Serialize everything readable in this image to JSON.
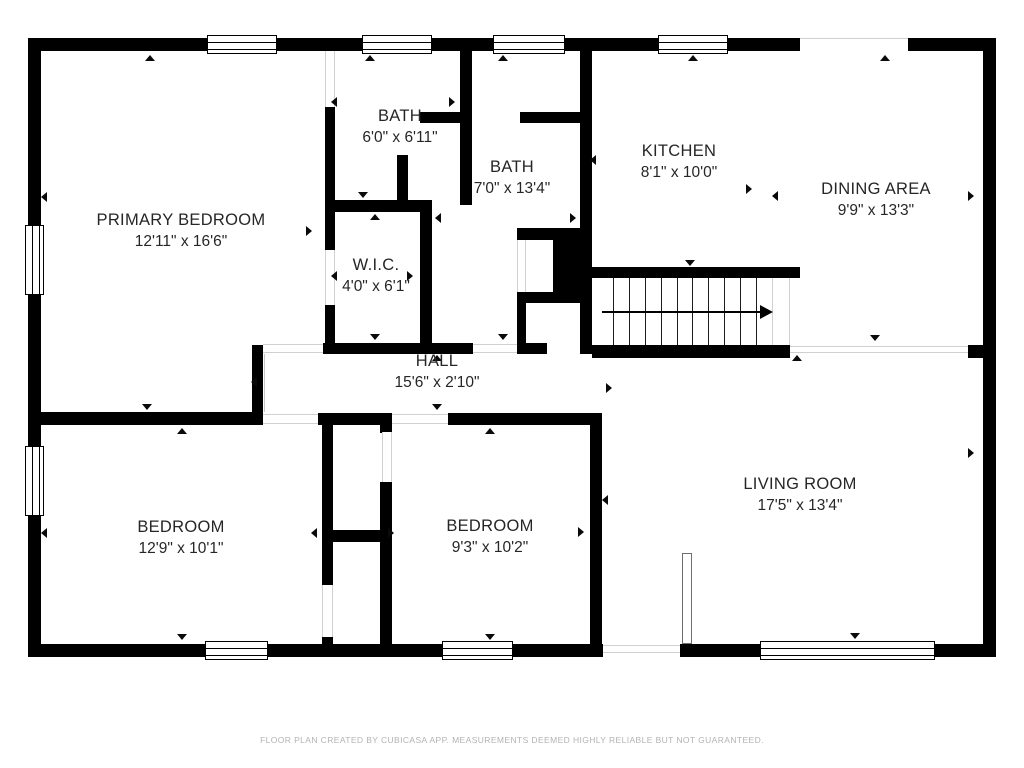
{
  "footer": "FLOOR PLAN CREATED BY CUBICASA APP. MEASUREMENTS DEEMED HIGHLY RELIABLE BUT NOT GUARANTEED.",
  "colors": {
    "wall": "#000000",
    "text": "#262626",
    "opening_line": "#d0d0d0",
    "footer_text": "#b3b3b3",
    "background": "#ffffff"
  },
  "rooms": [
    {
      "name": "PRIMARY BEDROOM",
      "dims": "12'11\" x 16'6\"",
      "cx": 181,
      "cy": 231
    },
    {
      "name": "BATH",
      "dims": "6'0\" x 6'11\"",
      "cx": 400,
      "cy": 127
    },
    {
      "name": "BATH",
      "dims": "7'0\" x 13'4\"",
      "cx": 512,
      "cy": 178
    },
    {
      "name": "KITCHEN",
      "dims": "8'1\" x 10'0\"",
      "cx": 679,
      "cy": 162
    },
    {
      "name": "DINING AREA",
      "dims": "9'9\" x 13'3\"",
      "cx": 876,
      "cy": 200
    },
    {
      "name": "W.I.C.",
      "dims": "4'0\" x 6'1\"",
      "cx": 376,
      "cy": 276
    },
    {
      "name": "HALL",
      "dims": "15'6\" x 2'10\"",
      "cx": 437,
      "cy": 372
    },
    {
      "name": "BEDROOM",
      "dims": "12'9\" x 10'1\"",
      "cx": 181,
      "cy": 538
    },
    {
      "name": "BEDROOM",
      "dims": "9'3\" x 10'2\"",
      "cx": 490,
      "cy": 537
    },
    {
      "name": "LIVING ROOM",
      "dims": "17'5\" x 13'4\"",
      "cx": 800,
      "cy": 495
    }
  ],
  "geometry": {
    "walls": [
      [
        28,
        38,
        772,
        13
      ],
      [
        908,
        38,
        88,
        13
      ],
      [
        28,
        38,
        13,
        619
      ],
      [
        983,
        38,
        13,
        619
      ],
      [
        28,
        644,
        575,
        13
      ],
      [
        680,
        644,
        316,
        13
      ],
      [
        325,
        107,
        10,
        143
      ],
      [
        325,
        305,
        10,
        40
      ],
      [
        335,
        200,
        97,
        12
      ],
      [
        420,
        212,
        12,
        133
      ],
      [
        323,
        343,
        150,
        11
      ],
      [
        460,
        38,
        12,
        167
      ],
      [
        420,
        112,
        40,
        11
      ],
      [
        520,
        112,
        60,
        11
      ],
      [
        397,
        155,
        11,
        50
      ],
      [
        580,
        38,
        12,
        316
      ],
      [
        592,
        267,
        208,
        11
      ],
      [
        592,
        345,
        198,
        13
      ],
      [
        968,
        345,
        15,
        13
      ],
      [
        517,
        228,
        68,
        12
      ],
      [
        517,
        292,
        70,
        11
      ],
      [
        517,
        303,
        9,
        40
      ],
      [
        517,
        343,
        30,
        11
      ],
      [
        252,
        345,
        11,
        80
      ],
      [
        28,
        412,
        234,
        13
      ],
      [
        318,
        413,
        74,
        12
      ],
      [
        448,
        413,
        152,
        12
      ],
      [
        322,
        425,
        11,
        160
      ],
      [
        322,
        637,
        11,
        8
      ],
      [
        380,
        425,
        12,
        8
      ],
      [
        380,
        482,
        12,
        165
      ],
      [
        322,
        530,
        70,
        12
      ],
      [
        590,
        413,
        12,
        234
      ],
      [
        553,
        237,
        34,
        58
      ]
    ],
    "windows": [
      {
        "r": [
          207,
          35,
          70,
          19
        ],
        "dir": "h"
      },
      {
        "r": [
          362,
          35,
          70,
          19
        ],
        "dir": "h"
      },
      {
        "r": [
          493,
          35,
          72,
          19
        ],
        "dir": "h"
      },
      {
        "r": [
          658,
          35,
          70,
          19
        ],
        "dir": "h"
      },
      {
        "r": [
          25,
          225,
          19,
          70
        ],
        "dir": "v"
      },
      {
        "r": [
          25,
          446,
          19,
          70
        ],
        "dir": "v"
      },
      {
        "r": [
          205,
          641,
          63,
          19
        ],
        "dir": "h"
      },
      {
        "r": [
          442,
          641,
          71,
          19
        ],
        "dir": "h"
      },
      {
        "r": [
          760,
          641,
          175,
          19
        ],
        "dir": "h"
      }
    ],
    "openings": [
      {
        "r": [
          800,
          38,
          108,
          13
        ],
        "t": "line-top"
      },
      {
        "r": [
          790,
          346,
          178,
          7
        ],
        "t": "band-h"
      },
      {
        "r": [
          603,
          645,
          77,
          8
        ],
        "t": "band-h"
      },
      {
        "r": [
          473,
          344,
          44,
          9
        ],
        "t": "band-h"
      },
      {
        "r": [
          263,
          344,
          60,
          9
        ],
        "t": "band-h"
      },
      {
        "r": [
          263,
          414,
          55,
          10
        ],
        "t": "band-h"
      },
      {
        "r": [
          392,
          414,
          56,
          10
        ],
        "t": "band-h"
      },
      {
        "r": [
          325,
          250,
          10,
          55
        ],
        "t": "band-v"
      },
      {
        "r": [
          325,
          51,
          10,
          56
        ],
        "t": "band-v"
      },
      {
        "r": [
          517,
          240,
          9,
          52
        ],
        "t": "band-v"
      },
      {
        "r": [
          382,
          432,
          10,
          50
        ],
        "t": "band-v"
      },
      {
        "r": [
          322,
          585,
          11,
          52
        ],
        "t": "band-v"
      },
      {
        "r": [
          772,
          278,
          18,
          67
        ],
        "t": "band-v"
      },
      {
        "r": [
          682,
          553,
          10,
          91
        ],
        "t": "box"
      }
    ],
    "leaves": [
      [
        264,
        354,
        1,
        58
      ]
    ],
    "stairs": {
      "box": [
        597,
        278,
        175,
        67
      ],
      "treads": 11,
      "arrow": {
        "x1": 602,
        "y": 311,
        "x2": 762
      }
    },
    "markers": {
      "up": [
        [
          150,
          60
        ],
        [
          370,
          60
        ],
        [
          503,
          60
        ],
        [
          693,
          60
        ],
        [
          885,
          60
        ],
        [
          182,
          433
        ],
        [
          490,
          433
        ],
        [
          797,
          360
        ],
        [
          437,
          360
        ],
        [
          375,
          219
        ]
      ],
      "down": [
        [
          147,
          409
        ],
        [
          437,
          409
        ],
        [
          363,
          197
        ],
        [
          503,
          339
        ],
        [
          690,
          265
        ],
        [
          875,
          340
        ],
        [
          182,
          639
        ],
        [
          490,
          639
        ],
        [
          855,
          638
        ],
        [
          375,
          339
        ]
      ],
      "left": [
        [
          46,
          197
        ],
        [
          46,
          533
        ],
        [
          336,
          102
        ],
        [
          316,
          533
        ],
        [
          256,
          382
        ],
        [
          595,
          160
        ],
        [
          777,
          196
        ],
        [
          607,
          500
        ],
        [
          336,
          276
        ],
        [
          440,
          218
        ]
      ],
      "right": [
        [
          454,
          102
        ],
        [
          393,
          533
        ],
        [
          583,
          532
        ],
        [
          611,
          388
        ],
        [
          751,
          189
        ],
        [
          973,
          196
        ],
        [
          973,
          453
        ],
        [
          575,
          218
        ],
        [
          412,
          276
        ],
        [
          311,
          231
        ]
      ]
    }
  }
}
